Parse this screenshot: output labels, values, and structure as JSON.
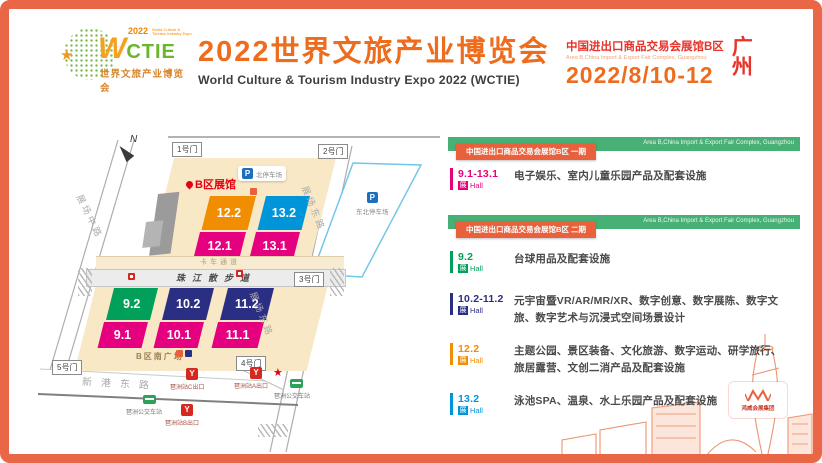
{
  "header": {
    "logo": {
      "w": "W",
      "ctie": "CTIE",
      "year": "2022",
      "tagline_en": "World Culture & Tourism Industry Expo",
      "tagline": "世界文旅产业博览会"
    },
    "title_zh": "2022世界文旅产业博览会",
    "title_en": "World Culture & Tourism Industry Expo 2022 (WCTIE)",
    "venue_zh": "中国进出口商品交易会展馆B区",
    "venue_en": "Area B China Import & Export Fair Complex, Guangzhou",
    "date": "2022/8/10-12",
    "city_top": "广",
    "city_bottom": "州"
  },
  "map": {
    "compass": "N",
    "area_label": "B区展馆",
    "gates": [
      "1号门",
      "2号门",
      "3号门",
      "4号门",
      "5号门"
    ],
    "parking_icon": "P",
    "north_parking": "北停车场",
    "east_parking": "东北停车场",
    "truck_lane": "卡车通道",
    "promenade": "珠江散步道",
    "south_plaza": "B区南广场",
    "road_west": "展场中路",
    "road_east": "展场东路",
    "road_south": "新港东路",
    "metro_exits": [
      "琶洲站C出口",
      "琶洲站A出口",
      "琶洲站B出口"
    ],
    "bus_stops": [
      "琶洲公交车站",
      "琶洲公交车站"
    ],
    "star": "★",
    "halls": [
      {
        "id": "12.2",
        "color": "#F18D00"
      },
      {
        "id": "13.2",
        "color": "#0095D8"
      },
      {
        "id": "12.1",
        "color": "#E5007F"
      },
      {
        "id": "13.1",
        "color": "#E5007F"
      },
      {
        "id": "9.2",
        "color": "#00A05A"
      },
      {
        "id": "10.2",
        "color": "#2B2F84"
      },
      {
        "id": "11.2",
        "color": "#2B2F84"
      },
      {
        "id": "9.1",
        "color": "#E5007F"
      },
      {
        "id": "10.1",
        "color": "#E5007F"
      },
      {
        "id": "11.1",
        "color": "#E5007F"
      }
    ]
  },
  "panel": {
    "hall_label": {
      "zh": "展",
      "en": "Hall"
    },
    "sections": [
      {
        "badge": "中国进出口商品交易会展馆B区 一期",
        "banner_en": "Area B,China Import & Export Fair Complex, Guangzhou",
        "entries": [
          {
            "range": "9.1-13.1",
            "color": "#E5007F",
            "desc": "电子娱乐、室内儿童乐园产品及配套设施"
          }
        ]
      },
      {
        "badge": "中国进出口商品交易会展馆B区 二期",
        "banner_en": "Area B,China Import & Export Fair Complex, Guangzhou",
        "entries": [
          {
            "range": "9.2",
            "color": "#00A05A",
            "desc": "台球用品及配套设施"
          },
          {
            "range": "10.2-11.2",
            "color": "#2B2F84",
            "desc": "元宇宙暨VR/AR/MR/XR、数字创意、数字展陈、数字文旅、数字艺术与沉浸式空间场景设计"
          },
          {
            "range": "12.2",
            "color": "#F18D00",
            "desc": "主题公园、景区装备、文化旅游、数字运动、研学旅行、旅居露营、文创二消产品及配套设施"
          },
          {
            "range": "13.2",
            "color": "#0095D8",
            "desc": "泳池SPA、温泉、水上乐园产品及配套设施"
          }
        ]
      }
    ],
    "footer_logo_text": "鸿威会展集团"
  },
  "colors": {
    "frame": "#E96746",
    "accent_orange": "#ED6C1E",
    "accent_red": "#E8332A",
    "banner_green": "#47B075",
    "badge_orange": "#E8613C"
  }
}
